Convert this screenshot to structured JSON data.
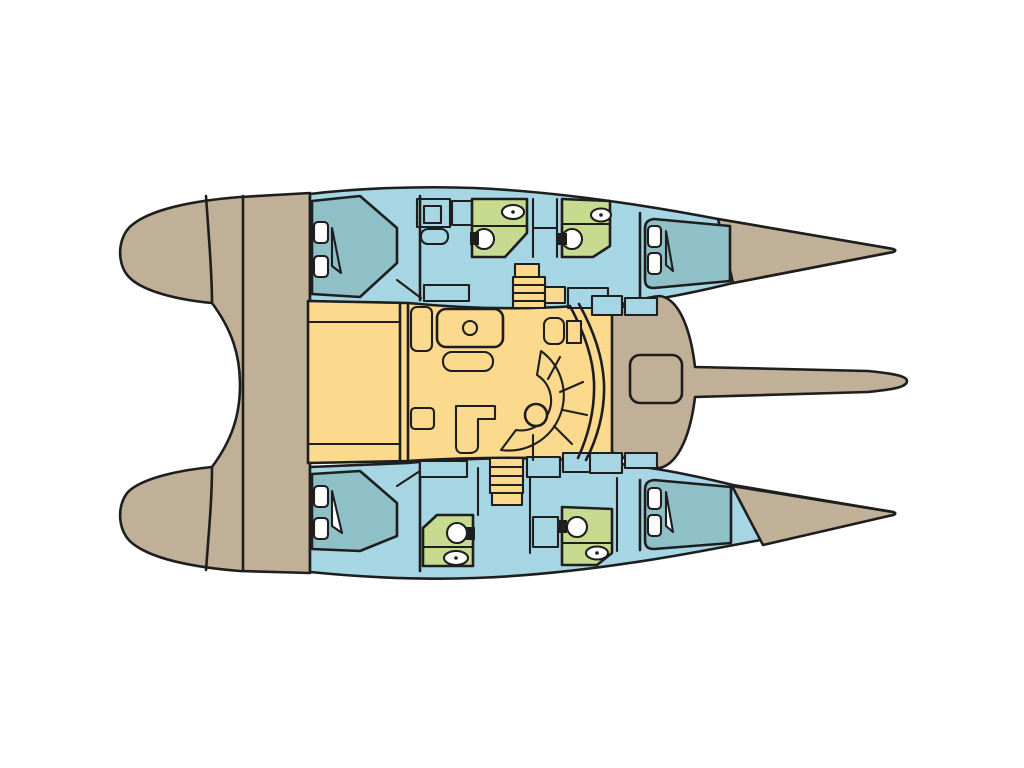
{
  "diagram": {
    "type": "catamaran-deck-plan-top-view",
    "colors": {
      "background": "#FFFFFF",
      "outline": "#1E1E1E",
      "hull": "#C1B098",
      "cabin": "#A6D6E3",
      "berth": "#8FBFC7",
      "bathroom": "#C6DB90",
      "saloon": "#FBD98D",
      "fixture": "#FFFFFF"
    },
    "regions": [
      {
        "name": "stern-swim-platforms",
        "color_key": "hull"
      },
      {
        "name": "aft-deck",
        "color_key": "hull"
      },
      {
        "name": "cockpit",
        "color_key": "saloon"
      },
      {
        "name": "saloon-with-dinette-and-galley",
        "color_key": "saloon"
      },
      {
        "name": "port-hull-cabins",
        "color_key": "cabin"
      },
      {
        "name": "starboard-hull-cabins",
        "color_key": "cabin"
      },
      {
        "name": "double-berths",
        "color_key": "berth"
      },
      {
        "name": "bathrooms",
        "color_key": "bathroom"
      },
      {
        "name": "foredeck-nacelle-with-hatch",
        "color_key": "hull"
      },
      {
        "name": "bowsprit",
        "color_key": "hull"
      }
    ]
  }
}
